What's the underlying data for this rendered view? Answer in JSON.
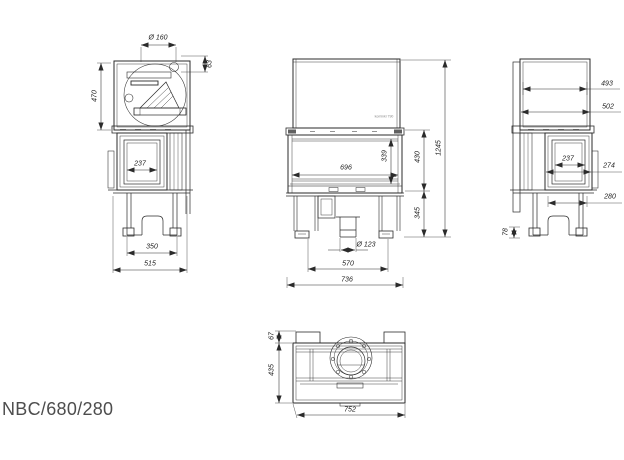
{
  "title": "NBC/680/280",
  "drawing": {
    "line_color": "#2b2b2b",
    "title_color": "#4d4d4d",
    "logo_icon": "⊕",
    "logo_text": "kominki 790",
    "views": {
      "side_left": {
        "name": "left-side-view",
        "dims": {
          "flue_diameter": "Ø 160",
          "flue_offset": "63",
          "upper_body_height": "470",
          "side_glass_width": "237",
          "base_width": "350",
          "overall_depth": "515"
        }
      },
      "front": {
        "name": "front-view",
        "dims": {
          "glass_width": "696",
          "glass_height": "339",
          "firebox_height": "430",
          "base_height": "345",
          "overall_height": "1245",
          "air_inlet_diameter": "Ø 123",
          "base_width": "570",
          "overall_width": "736"
        }
      },
      "side_right": {
        "name": "right-side-view",
        "dims": {
          "depth_top": "493",
          "depth_overall": "502",
          "side_glass_width": "237",
          "side_frame_width": "274",
          "lower_depth": "280",
          "foot_height": "78"
        }
      },
      "top": {
        "name": "top-view",
        "dims": {
          "front_panel_depth": "67",
          "body_depth": "435",
          "overall_width": "752"
        }
      }
    }
  }
}
